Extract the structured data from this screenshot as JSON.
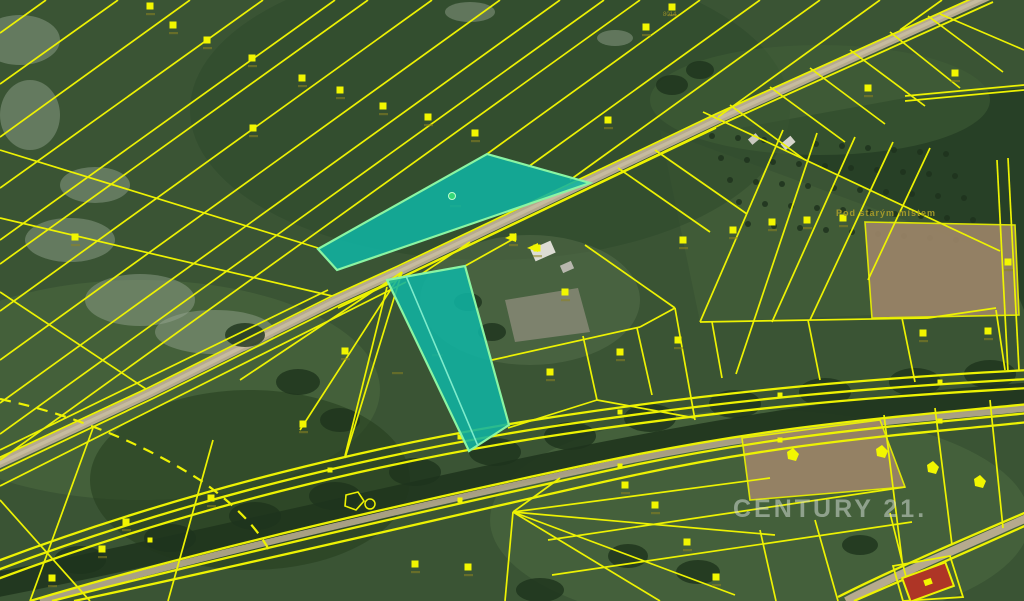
{
  "watermark": {
    "text": "CENTURY 21."
  },
  "place_label": {
    "text": "Pod starým místem"
  },
  "tiny_labels": [
    {
      "text": "8014"
    }
  ],
  "colors": {
    "cadastral_line": "#edf203",
    "highlight_fill": "#10b3a2",
    "highlight_stroke": "#8af5a3",
    "highlight_divider": "#7deccc",
    "road": "#b6aa8e",
    "road_center": "#cdc2a6",
    "river": "#20351e",
    "marker": "#f2f600",
    "marker_smudge": "#8c8420",
    "building_red": "#ae3526",
    "building_white": "#dddcd4",
    "watermark_gray": "#ced7d0",
    "label_olive": "#a79b2a",
    "green_dot": "#35d877"
  },
  "map": {
    "highlighted_parcels": [
      {
        "name": "highlight-parcel-north",
        "points": "318,249 487,154 590,183 337,270"
      },
      {
        "name": "highlight-parcel-strip",
        "points": "387,280 465,266 509,425 469,451",
        "divider": [
          406,
          276,
          478,
          446
        ]
      }
    ],
    "highlight_marker": {
      "x": 452,
      "y": 196
    },
    "lines": [
      [
        46,
        0,
        0,
        33
      ],
      [
        118,
        0,
        0,
        84
      ],
      [
        190,
        0,
        0,
        137
      ],
      [
        263,
        0,
        0,
        188
      ],
      [
        335,
        0,
        0,
        240
      ],
      [
        368,
        0,
        0,
        264
      ],
      [
        432,
        0,
        0,
        311
      ],
      [
        500,
        0,
        0,
        360
      ],
      [
        560,
        0,
        0,
        403
      ],
      [
        604,
        0,
        0,
        434
      ],
      [
        640,
        0,
        0,
        460
      ],
      [
        700,
        0,
        487,
        154
      ],
      [
        760,
        0,
        528,
        167
      ],
      [
        820,
        0,
        570,
        180
      ],
      [
        880,
        0,
        718,
        117
      ],
      [
        942,
        0,
        900,
        30
      ],
      [
        0,
        150,
        318,
        248
      ],
      [
        0,
        218,
        332,
        296
      ],
      [
        0,
        292,
        146,
        389
      ],
      [
        328,
        290,
        0,
        450
      ],
      [
        716,
        128,
        338,
        308
      ],
      [
        406,
        282,
        0,
        486
      ],
      [
        402,
        272,
        240,
        380
      ],
      [
        402,
        272,
        300,
        430
      ],
      [
        402,
        272,
        345,
        458
      ],
      [
        345,
        456,
        387,
        287
      ],
      [
        420,
        275,
        470,
        242
      ],
      [
        465,
        266,
        515,
        238
      ],
      [
        585,
        245,
        675,
        308
      ],
      [
        675,
        308,
        695,
        420
      ],
      [
        492,
        360,
        640,
        327
      ],
      [
        640,
        327,
        675,
        308
      ],
      [
        583,
        336,
        597,
        400
      ],
      [
        637,
        328,
        652,
        395
      ],
      [
        508,
        428,
        597,
        400
      ],
      [
        597,
        400,
        695,
        418
      ],
      [
        618,
        168,
        710,
        232
      ],
      [
        655,
        150,
        747,
        214
      ],
      [
        700,
        322,
        928,
        318
      ],
      [
        928,
        318,
        996,
        308
      ],
      [
        783,
        130,
        700,
        322
      ],
      [
        817,
        133,
        736,
        374
      ],
      [
        855,
        137,
        772,
        322
      ],
      [
        893,
        142,
        810,
        320
      ],
      [
        930,
        148,
        868,
        280
      ],
      [
        905,
        96,
        1024,
        85
      ],
      [
        905,
        101,
        1024,
        90
      ],
      [
        940,
        14,
        1024,
        50
      ],
      [
        997,
        160,
        1008,
        372
      ],
      [
        1008,
        158,
        1019,
        370
      ],
      [
        712,
        322,
        722,
        378
      ],
      [
        808,
        320,
        820,
        380
      ],
      [
        902,
        318,
        915,
        382
      ],
      [
        996,
        310,
        1005,
        370
      ],
      [
        703,
        112,
        1000,
        251
      ],
      [
        730,
        105,
        805,
        160
      ],
      [
        770,
        87,
        845,
        142
      ],
      [
        810,
        68,
        885,
        124
      ],
      [
        850,
        50,
        925,
        106
      ],
      [
        890,
        32,
        960,
        88
      ],
      [
        928,
        16,
        1003,
        72
      ],
      [
        93,
        428,
        30,
        601
      ],
      [
        213,
        440,
        168,
        601
      ],
      [
        0,
        500,
        90,
        601
      ],
      [
        548,
        540,
        905,
        487
      ],
      [
        552,
        575,
        912,
        522
      ],
      [
        815,
        520,
        838,
        601
      ],
      [
        890,
        513,
        912,
        601
      ],
      [
        760,
        530,
        776,
        601
      ],
      [
        513,
        512,
        770,
        478
      ],
      [
        513,
        512,
        775,
        535
      ],
      [
        513,
        512,
        735,
        595
      ],
      [
        513,
        512,
        660,
        601
      ],
      [
        513,
        512,
        560,
        478
      ],
      [
        513,
        512,
        505,
        601
      ],
      [
        884,
        415,
        902,
        560
      ],
      [
        935,
        408,
        952,
        545
      ],
      [
        990,
        400,
        1003,
        528
      ]
    ],
    "arcs": [
      "M -5,562 C 180,492 380,443 560,416 S 880,378 1029,370",
      "M -5,571 C 180,501 380,452 562,425 S 880,387 1029,379",
      "M -5,580 C 182,510 382,461 564,434 S 882,396 1029,388",
      "M 30,601 C 200,550 420,500 600,462 S 900,417 1029,404",
      "M 52,601 C 220,558 432,509 606,471 S 902,426 1029,413",
      "M 74,601 C 240,566 442,518 612,480 S 904,435 1029,422",
      "M 838,597 C 885,573 945,547 1029,511",
      "M 854,601 C 898,582 958,556 1029,524"
    ],
    "dashed": [
      "M 0,399 C 80,416 150,448 200,480 C 240,508 262,534 272,556"
    ],
    "road_main": "M 988,-4 L 720,118 L 402,270 L 336,300 L 150,393 L -4,465",
    "road_edges": [
      "M 984,-7 L 716,114 L 398,266 L 332,296 L 146,389 L -6,460",
      "M 993,2 L 724,123 L 406,275 L 340,305 L 154,398 L 0,471"
    ],
    "road_corridor": "M 40,601 C 210,554 425,504 602,466 S 900,421 1029,408",
    "road_se": "M 846,601 C 890,578 950,552 1029,517",
    "river": "M -5,585 C 200,545 420,490 600,455 S 890,405 1029,395",
    "brown_fields": [
      "865,222 1015,225 1019,315 872,318",
      "742,438 880,420 905,487 750,500"
    ],
    "zone_polys": [
      {
        "points": "740,128 905,98 1024,88 1024,310 1000,252",
        "fill": "#263e25",
        "op": 0.9
      },
      {
        "points": "660,130 1000,255 1000,310 700,322",
        "fill": "#45623a",
        "op": 0.5
      }
    ],
    "zone_ellipses": [
      [
        490,
        110,
        300,
        150,
        "#2d482b",
        0.55
      ],
      [
        140,
        390,
        240,
        110,
        "#4d6b40",
        0.5
      ],
      [
        760,
        520,
        270,
        110,
        "#4e6b41",
        0.5
      ],
      [
        820,
        100,
        170,
        55,
        "#415f38",
        0.5
      ],
      [
        530,
        300,
        110,
        65,
        "#5a7350",
        0.45
      ],
      [
        250,
        480,
        160,
        90,
        "#26401f",
        0.6
      ]
    ],
    "light_patches": [
      [
        70,
        240,
        45,
        22
      ],
      [
        140,
        300,
        55,
        26
      ],
      [
        215,
        332,
        60,
        22
      ],
      [
        95,
        185,
        35,
        18
      ],
      [
        30,
        115,
        30,
        35
      ],
      [
        20,
        40,
        40,
        25
      ],
      [
        470,
        12,
        25,
        10
      ],
      [
        615,
        38,
        18,
        8
      ]
    ],
    "trees": [
      [
        80,
        560,
        26,
        14
      ],
      [
        170,
        538,
        26,
        14
      ],
      [
        255,
        516,
        26,
        14
      ],
      [
        335,
        496,
        26,
        14
      ],
      [
        415,
        472,
        26,
        14
      ],
      [
        495,
        452,
        26,
        14
      ],
      [
        570,
        436,
        26,
        14
      ],
      [
        650,
        418,
        26,
        14
      ],
      [
        735,
        404,
        26,
        14
      ],
      [
        825,
        392,
        26,
        14
      ],
      [
        915,
        382,
        26,
        14
      ],
      [
        990,
        374,
        26,
        14
      ],
      [
        245,
        335,
        20,
        12
      ],
      [
        298,
        382,
        22,
        13
      ],
      [
        340,
        420,
        20,
        12
      ],
      [
        672,
        85,
        16,
        10
      ],
      [
        700,
        70,
        14,
        9
      ],
      [
        468,
        302,
        14,
        9
      ],
      [
        492,
        332,
        14,
        9
      ],
      [
        628,
        556,
        20,
        12
      ],
      [
        698,
        572,
        22,
        12
      ],
      [
        860,
        545,
        18,
        10
      ],
      [
        540,
        590,
        24,
        12
      ]
    ],
    "orchard": {
      "x0": 712,
      "y0": 136,
      "cols": 10,
      "rows": 5,
      "dx": 26,
      "dy": 22,
      "skx": 9,
      "sky": 2
    },
    "markers": [
      [
        150,
        6
      ],
      [
        173,
        25
      ],
      [
        207,
        40
      ],
      [
        252,
        58
      ],
      [
        302,
        78
      ],
      [
        253,
        128
      ],
      [
        340,
        90
      ],
      [
        383,
        106
      ],
      [
        428,
        117
      ],
      [
        475,
        133
      ],
      [
        608,
        120
      ],
      [
        672,
        7
      ],
      [
        646,
        27
      ],
      [
        868,
        88
      ],
      [
        955,
        73
      ],
      [
        513,
        237
      ],
      [
        537,
        248
      ],
      [
        565,
        292
      ],
      [
        620,
        352
      ],
      [
        678,
        340
      ],
      [
        550,
        372
      ],
      [
        772,
        222
      ],
      [
        807,
        220
      ],
      [
        843,
        218
      ],
      [
        733,
        230
      ],
      [
        683,
        240
      ],
      [
        1008,
        262
      ],
      [
        625,
        485
      ],
      [
        655,
        505
      ],
      [
        687,
        542
      ],
      [
        716,
        577
      ],
      [
        415,
        564
      ],
      [
        468,
        567
      ],
      [
        211,
        498
      ],
      [
        126,
        522
      ],
      [
        102,
        549
      ],
      [
        52,
        578
      ],
      [
        345,
        351
      ],
      [
        303,
        424
      ],
      [
        75,
        237
      ],
      [
        923,
        333
      ],
      [
        988,
        331
      ]
    ],
    "nodes": [
      [
        460,
        437
      ],
      [
        620,
        412
      ],
      [
        780,
        395
      ],
      [
        940,
        382
      ],
      [
        460,
        500
      ],
      [
        620,
        466
      ],
      [
        780,
        440
      ],
      [
        940,
        421
      ],
      [
        330,
        470
      ],
      [
        150,
        540
      ]
    ],
    "blobs": [
      [
        793,
        455
      ],
      [
        882,
        452
      ],
      [
        933,
        468
      ],
      [
        980,
        482
      ]
    ],
    "arrows": [
      [
        512,
        238
      ],
      [
        534,
        248
      ]
    ],
    "smudges": [
      [
        437,
        354
      ],
      [
        397,
        372
      ],
      [
        455,
        205
      ]
    ],
    "buildings": [
      {
        "x": 543,
        "y": 251,
        "w": 22,
        "h": 13,
        "a": -24,
        "fill": "#dddcd4"
      },
      {
        "x": 567,
        "y": 267,
        "w": 12,
        "h": 8,
        "a": -24,
        "fill": "#b8b7ae"
      },
      {
        "x": 788,
        "y": 143,
        "w": 13,
        "h": 8,
        "a": -40,
        "fill": "#d6d5cc"
      },
      {
        "x": 754,
        "y": 139,
        "w": 10,
        "h": 7,
        "a": -40,
        "fill": "#c9c8bf"
      }
    ],
    "farmyard": "505,300 578,288 590,332 515,342",
    "red_building": {
      "x": 928,
      "y": 582,
      "w": 46,
      "h": 25,
      "a": -20
    },
    "red_building_parcel": "893,566 950,556 963,597 903,601",
    "pentagon": "M 346,495 L 358,492 L 364,501 L 356,510 L 345,506 Z",
    "pentagon2": {
      "x": 370,
      "y": 504,
      "r": 5
    }
  }
}
